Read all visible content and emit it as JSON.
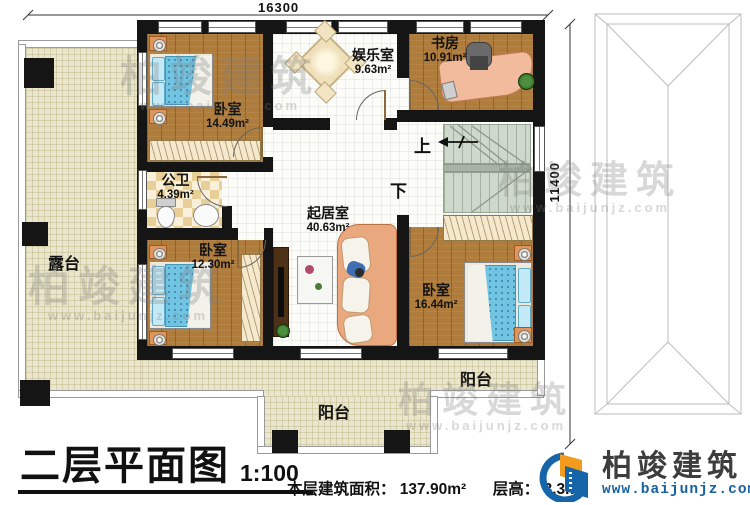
{
  "dimensions": {
    "width_top": "16300",
    "height_right": "11400"
  },
  "rooms": {
    "bedroom_tl": {
      "label": "卧室",
      "area": "14.49m²"
    },
    "bathroom": {
      "label": "公卫",
      "area": "4.39m²"
    },
    "bedroom_bl": {
      "label": "卧室",
      "area": "12.30m²"
    },
    "entertainment": {
      "label": "娱乐室",
      "area": "9.63m²"
    },
    "study": {
      "label": "书房",
      "area": "10.91m²"
    },
    "living": {
      "label": "起居室",
      "area": "40.63m²"
    },
    "bedroom_br": {
      "label": "卧室",
      "area": "16.44m²"
    },
    "terrace": {
      "label": "露台"
    },
    "balcony_bottom": {
      "label": "阳台"
    },
    "balcony_right": {
      "label": "阳台"
    }
  },
  "stairs": {
    "up": "上",
    "down": "下"
  },
  "footer": {
    "title": "二层平面图",
    "scale": "1:100",
    "area_text": "本层建筑面积： 137.90m²",
    "height_text": "层高： 3.3m"
  },
  "brand": {
    "name": "柏竣建筑",
    "url": "www.baijunjz.com"
  },
  "watermark": {
    "name": "柏竣建筑",
    "url": "www.baijunjz.com"
  },
  "colors": {
    "wall": "#151515",
    "wood_floor": "#b07c3c",
    "terrace_floor": "#eae6ce",
    "bed": "#72c4e3",
    "stair": "#cfd9cb",
    "brand_blue": "#1565a8",
    "brand_orange": "#f29b1d"
  }
}
